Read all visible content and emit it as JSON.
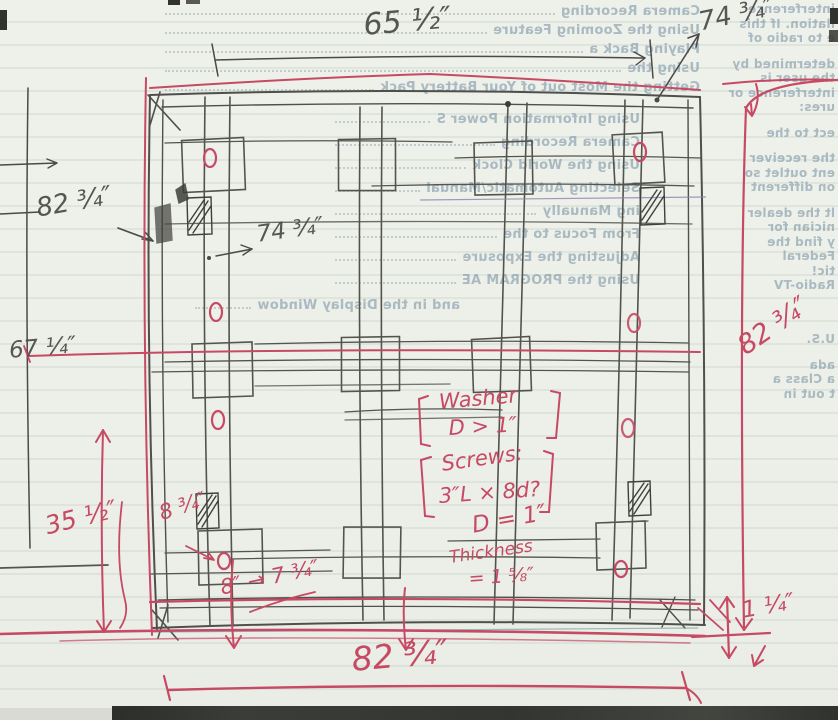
{
  "annotations": {
    "top_width": "65 ½″",
    "top_right_diag": "74 ¾″",
    "left_height": "82 ¾″",
    "inner_width": "74 ¾″",
    "far_left_height": "67 ¼″",
    "right_height": "82 ¾″",
    "washer_line1": "Washer",
    "washer_line2": "D > 1″",
    "screws_line1": "Screws:",
    "screws_line2": "3″L × 8d?",
    "hole_diameter": "D = 1″",
    "thickness_line1": "Thickness",
    "thickness_line2": "= 1 ⅝″",
    "bottom_left_height": "35 ½″",
    "side_offset": "8 ¾″",
    "revised_width": "8″ → 7 ¾″",
    "bottom_width": "82 ¾″",
    "bottom_right_gap": "1 ¼″"
  },
  "background": {
    "toc_top": [
      "Camera Recording",
      "Using the Zooming Feature",
      "Playing Back a",
      "Using the",
      "Getting the Most out of Your Battery Pack"
    ],
    "toc_mid": [
      "Using Information Power S",
      "Camera Recording",
      "Using the World Clock",
      "Selecting Automatic/Manual",
      "ing Manually",
      "From Focus to the",
      "Adjusting the Exposure",
      "Using the PROGRAM AE"
    ],
    "display_line": "and in the Display Window",
    "right_col": [
      "interference",
      "llation. If this",
      "e to radio of",
      "determined by",
      "the user is",
      "interference or",
      "ures:",
      "ect to the",
      "the receiver",
      "ent outlet so",
      "on different",
      "lt the dealer",
      "nician for",
      "y find the",
      "Federal",
      "tic!",
      "Radio-TV"
    ],
    "bottom_right_col": [
      "U.S.",
      "ada",
      "a Class a",
      "t out in"
    ]
  },
  "colors": {
    "ink_red": "#c64a63",
    "pencil": "#4a4a45",
    "paper": "#edefe9",
    "bleed_text": "#7c96a6"
  }
}
